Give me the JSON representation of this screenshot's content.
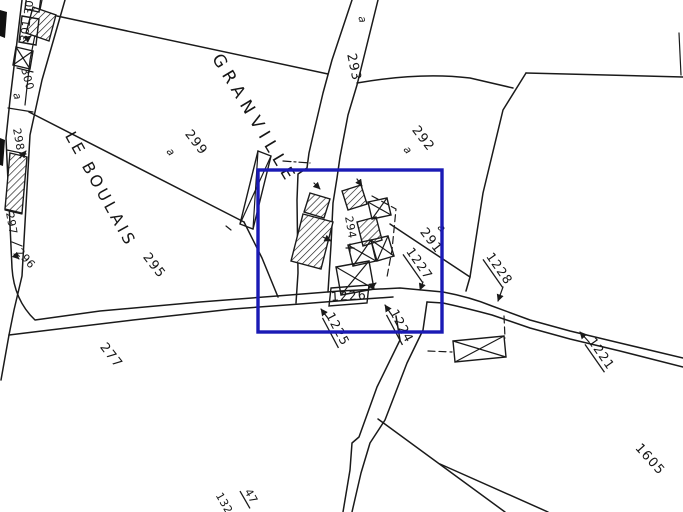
{
  "map": {
    "ink_color": "#1a1a1a",
    "selection": {
      "color": "#1a1ab5"
    },
    "place_names": {
      "granville": "GRANVILLE",
      "le_boulais": "LE BOULAIS"
    },
    "road_label": {
      "a": "a",
      "num": "293"
    },
    "parcels": {
      "p299": "299",
      "p299a": "a",
      "p292": "292",
      "p292a": "a",
      "p291": "291",
      "p291a": "a",
      "p295": "295",
      "p277": "277",
      "p294": "294",
      "p300": "300",
      "p300a": "a",
      "p301": "301",
      "p302": "302",
      "p298": "298",
      "p297": "297",
      "p296": "296",
      "p1605": "1605",
      "clip_left": "132",
      "clip_right": "47"
    },
    "road_tags": {
      "t1227": "1227",
      "t1228": "1228",
      "t1226": "1226",
      "t1225": "1225",
      "t1224": "1224",
      "t1221": "1221"
    }
  }
}
